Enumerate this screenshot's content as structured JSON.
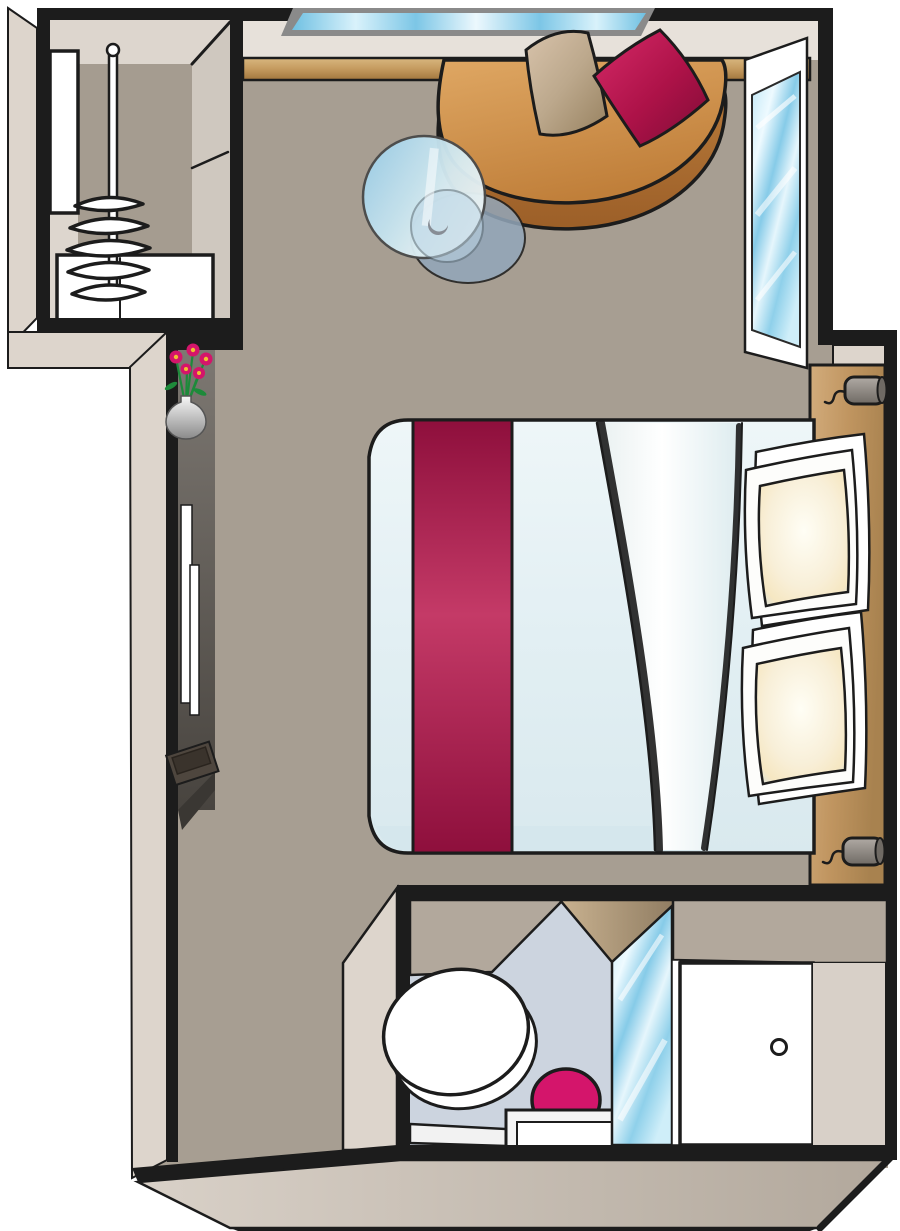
{
  "meta": {
    "title": "stateroom-floor-plan",
    "description": "Top-down illustrated floor plan of a stateroom with wardrobe, lounge area, double bed, vanity, bathroom and entry door",
    "text_content": "none (illustration only, no visible text)"
  },
  "palette": {
    "page_bg": "#ffffff",
    "wall_line": "#1c1c1c",
    "wall_face": "#ddd5cc",
    "wall_top": "#b2a89c",
    "inner_face": "#e7e1da",
    "floor": "#a79e92",
    "ledge_light": "#d9b77f",
    "ledge_dark": "#a1763d",
    "glass_light": "#e9f7fd",
    "glass_blue": "#6fc0e2",
    "wood_light": "#d2ac7c",
    "wood_dark": "#a8824f",
    "sofa_top_light": "#dca express05f",
    "sofa_top": "#d0924f",
    "sofa_side": "#a96f30",
    "cushion_beige_light": "#d8c3ab",
    "cushion_beige_dark": "#97815f",
    "cushion_magenta_light": "#d62a68",
    "cushion_magenta_dark": "#7e0c36",
    "runner_dark": "#8e0f3c",
    "runner_light": "#c43a67",
    "duvet_light": "#f2f8fa",
    "duvet_shadow": "#d9e9ee",
    "fold_white": "#ffffff",
    "fold_shadow": "#d8d2c2",
    "pillow_cream": "#f6e7c2",
    "pillow_white": "#ffffff",
    "vanity_light": "#7d7872",
    "vanity_dark": "#48443f",
    "tv_dark": "#4e463e",
    "vase_gray": "#9a9a9a",
    "flower_pink": "#d4156b",
    "flower_center": "#f0c030",
    "stem_green": "#1d8a3a",
    "bath_floor": "#ccd4df",
    "toilet_white": "#ffffff",
    "basin_magenta": "#d4156b",
    "door_white": "#ffffff",
    "sconce_light": "#b0aaa4",
    "sconce_dark": "#6f6a64",
    "table_glass": "#9fd0e8",
    "table_shadow": "#93a7ba"
  },
  "rooms": {
    "wardrobe": {
      "items": [
        "shelf",
        "hanging-rail",
        "hangers",
        "drawer-unit"
      ]
    },
    "main_cabin": {
      "items": [
        "top-window",
        "wall-ledge",
        "sofa",
        "cushion-beige",
        "cushion-magenta",
        "glass-table",
        "right-window",
        "double-bed",
        "bed-runner",
        "duvet-fold",
        "pillow-stack-top",
        "pillow-stack-bottom",
        "headboard",
        "wall-sconce-upper",
        "wall-sconce-lower",
        "vanity-counter",
        "vanity-mirror",
        "tv-unit",
        "flower-vase"
      ]
    },
    "bathroom": {
      "items": [
        "toilet",
        "washbasin",
        "vanity-shelf",
        "shower-glass"
      ]
    },
    "entry": {
      "items": [
        "entry-door",
        "door-knob"
      ]
    }
  }
}
